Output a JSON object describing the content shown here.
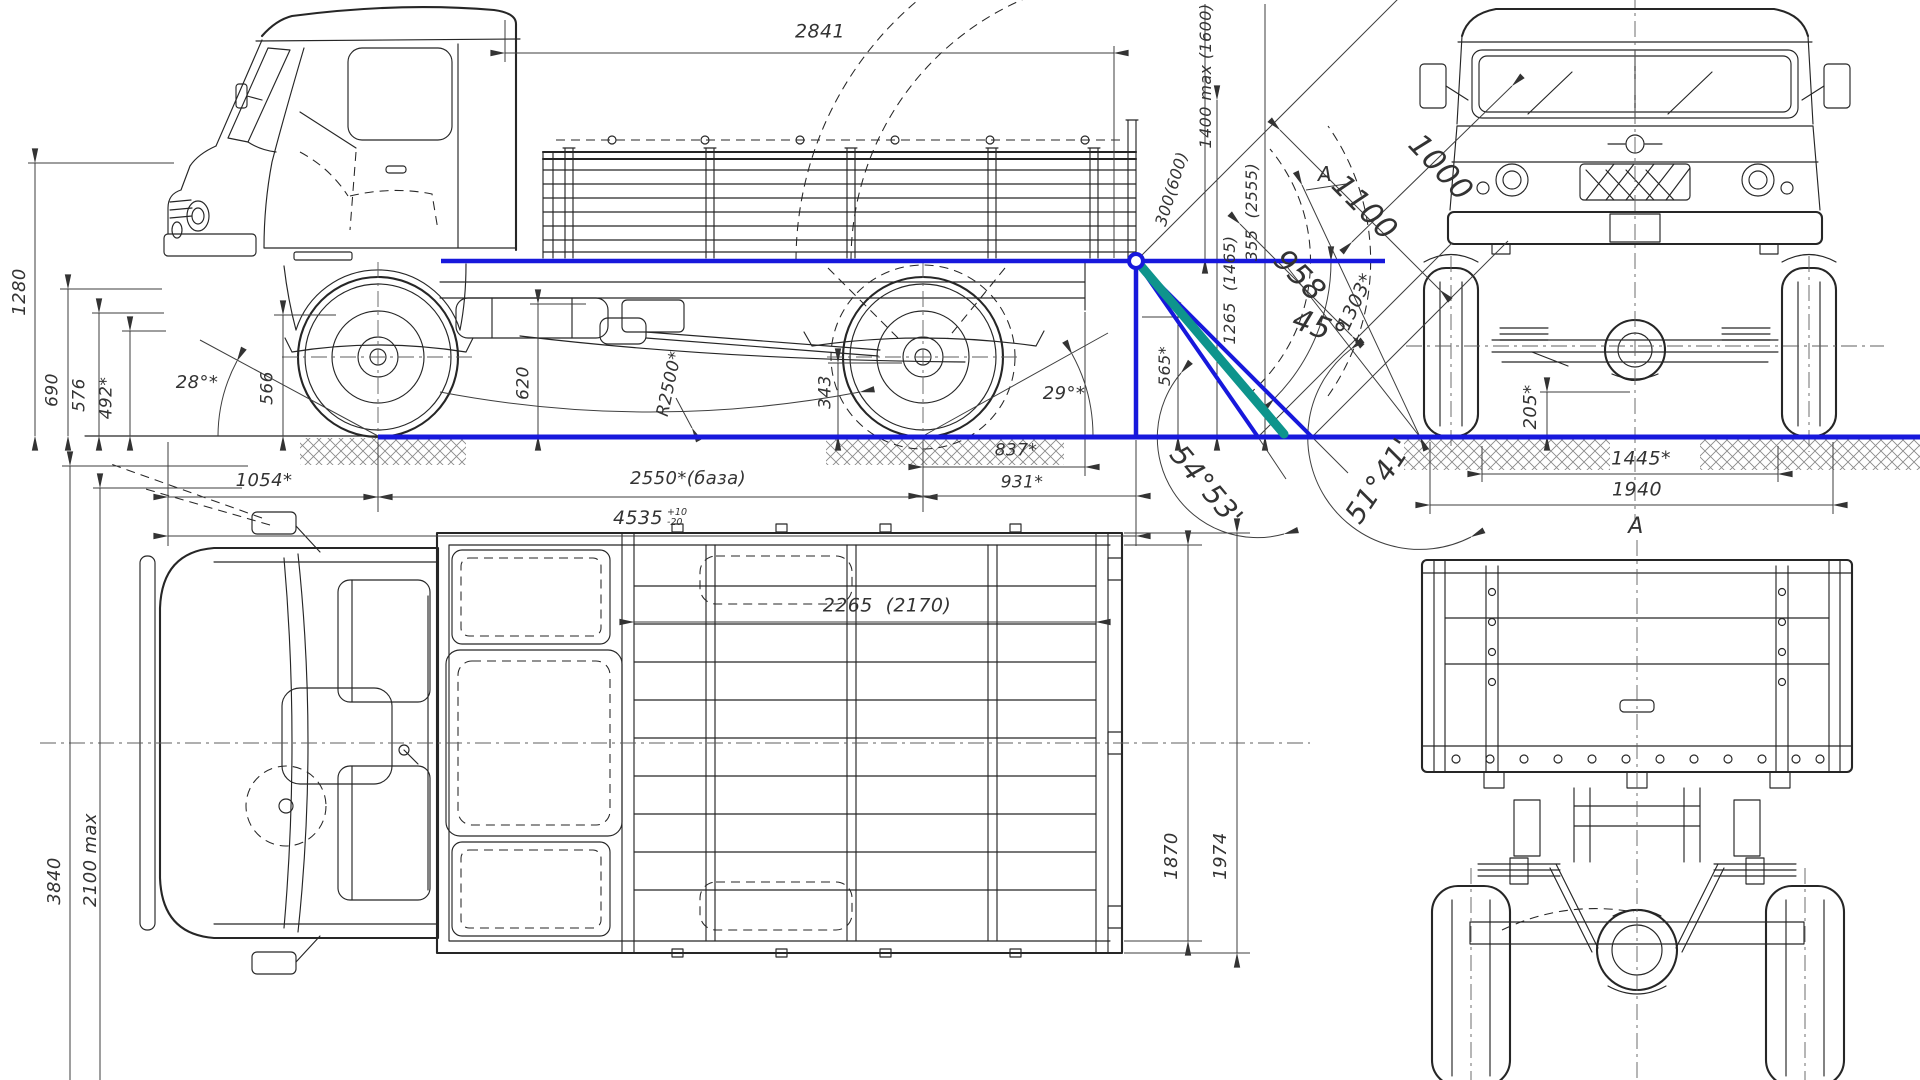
{
  "drawing_type": "truck-blueprint-4-views",
  "colors": {
    "reference_blue": "#1718dc",
    "loading_teal": "#0e948c",
    "line": "#262626",
    "dim_line": "#3e3e3e",
    "label_text": "#333333",
    "background": "#ffffff"
  },
  "views": {
    "side_view": "side elevation with loading-angle construction",
    "front_view": "front elevation",
    "top_view": "plan view",
    "rear_view": "rear elevation (view A)"
  },
  "labels": [
    {
      "id": "2841",
      "text": "2841",
      "x": 820,
      "y": 32,
      "rot": 0,
      "fs": 19
    },
    {
      "id": "1280",
      "text": "1280",
      "x": 20,
      "y": 292,
      "rot": -90,
      "fs": 18
    },
    {
      "id": "690",
      "text": "690",
      "x": 53,
      "y": 390,
      "rot": -90,
      "fs": 17
    },
    {
      "id": "576",
      "text": "576",
      "x": 80,
      "y": 395,
      "rot": -90,
      "fs": 17
    },
    {
      "id": "492",
      "text": "492*",
      "x": 107,
      "y": 398,
      "rot": -90,
      "fs": 17
    },
    {
      "id": "28deg",
      "text": "28°*",
      "x": 197,
      "y": 383,
      "rot": 0,
      "fs": 18
    },
    {
      "id": "566",
      "text": "566",
      "x": 268,
      "y": 388,
      "rot": -90,
      "fs": 17
    },
    {
      "id": "620",
      "text": "620",
      "x": 524,
      "y": 383,
      "rot": -90,
      "fs": 17
    },
    {
      "id": "R2500",
      "text": "R2500*",
      "x": 670,
      "y": 384,
      "rot": -78,
      "fs": 17
    },
    {
      "id": "343",
      "text": "343",
      "x": 826,
      "y": 392,
      "rot": -90,
      "fs": 17
    },
    {
      "id": "29deg",
      "text": "29°*",
      "x": 1064,
      "y": 394,
      "rot": 0,
      "fs": 18
    },
    {
      "id": "1054",
      "text": "1054*",
      "x": 264,
      "y": 481,
      "rot": 0,
      "fs": 18
    },
    {
      "id": "2550",
      "text": "2550*(база)",
      "x": 688,
      "y": 479,
      "rot": 0,
      "fs": 18
    },
    {
      "id": "4535",
      "text": "4535",
      "x": 650,
      "y": 518,
      "rot": 0,
      "fs": 19,
      "sup": "+10",
      "sub": "-20"
    },
    {
      "id": "837",
      "text": "837*",
      "x": 1016,
      "y": 451,
      "rot": 0,
      "fs": 17
    },
    {
      "id": "931",
      "text": "931*",
      "x": 1022,
      "y": 483,
      "rot": 0,
      "fs": 17
    },
    {
      "id": "1400max",
      "text": "1400 max (1600)",
      "x": 1206,
      "y": 76,
      "rot": -90,
      "fs": 16
    },
    {
      "id": "300600",
      "text": "300(600)",
      "x": 1172,
      "y": 189,
      "rot": -73,
      "fs": 16
    },
    {
      "id": "355",
      "text": "355  (2555)",
      "x": 1252,
      "y": 212,
      "rot": -90,
      "fs": 16
    },
    {
      "id": "1265",
      "text": "1265  (1465)",
      "x": 1230,
      "y": 290,
      "rot": -90,
      "fs": 16
    },
    {
      "id": "565",
      "text": "565*",
      "x": 1165,
      "y": 366,
      "rot": -90,
      "fs": 16
    },
    {
      "id": "958",
      "text": "958",
      "x": 1299,
      "y": 276,
      "rot": 45,
      "fs": 30
    },
    {
      "id": "45deg",
      "text": "45°",
      "x": 1319,
      "y": 328,
      "rot": 20,
      "fs": 30
    },
    {
      "id": "1303",
      "text": "1303*",
      "x": 1356,
      "y": 302,
      "rot": -65,
      "fs": 19
    },
    {
      "id": "1100",
      "text": "1100",
      "x": 1364,
      "y": 208,
      "rot": 45,
      "fs": 30
    },
    {
      "id": "1000",
      "text": "1000",
      "x": 1440,
      "y": 168,
      "rot": 47,
      "fs": 30
    },
    {
      "id": "A-side",
      "text": "A",
      "x": 1325,
      "y": 174,
      "rot": 0,
      "fs": 20
    },
    {
      "id": "5453",
      "text": "54°53'",
      "x": 1206,
      "y": 486,
      "rot": 50,
      "fs": 28
    },
    {
      "id": "5141",
      "text": "51°41'",
      "x": 1379,
      "y": 481,
      "rot": -56,
      "fs": 28
    },
    {
      "id": "205",
      "text": "205*",
      "x": 1531,
      "y": 407,
      "rot": -90,
      "fs": 18
    },
    {
      "id": "1445",
      "text": "1445*",
      "x": 1641,
      "y": 459,
      "rot": 0,
      "fs": 19
    },
    {
      "id": "1940",
      "text": "1940",
      "x": 1637,
      "y": 490,
      "rot": 0,
      "fs": 19
    },
    {
      "id": "A-rear",
      "text": "A",
      "x": 1636,
      "y": 527,
      "rot": 0,
      "fs": 22
    },
    {
      "id": "2265",
      "text": "2265  (2170)",
      "x": 887,
      "y": 606,
      "rot": 0,
      "fs": 19
    },
    {
      "id": "1870",
      "text": "1870",
      "x": 1172,
      "y": 856,
      "rot": -90,
      "fs": 18
    },
    {
      "id": "1974",
      "text": "1974",
      "x": 1221,
      "y": 856,
      "rot": -90,
      "fs": 18
    },
    {
      "id": "3840",
      "text": "3840",
      "x": 55,
      "y": 881,
      "rot": -90,
      "fs": 18
    },
    {
      "id": "2100max",
      "text": "2100 max",
      "x": 91,
      "y": 860,
      "rot": -90,
      "fs": 18
    }
  ]
}
